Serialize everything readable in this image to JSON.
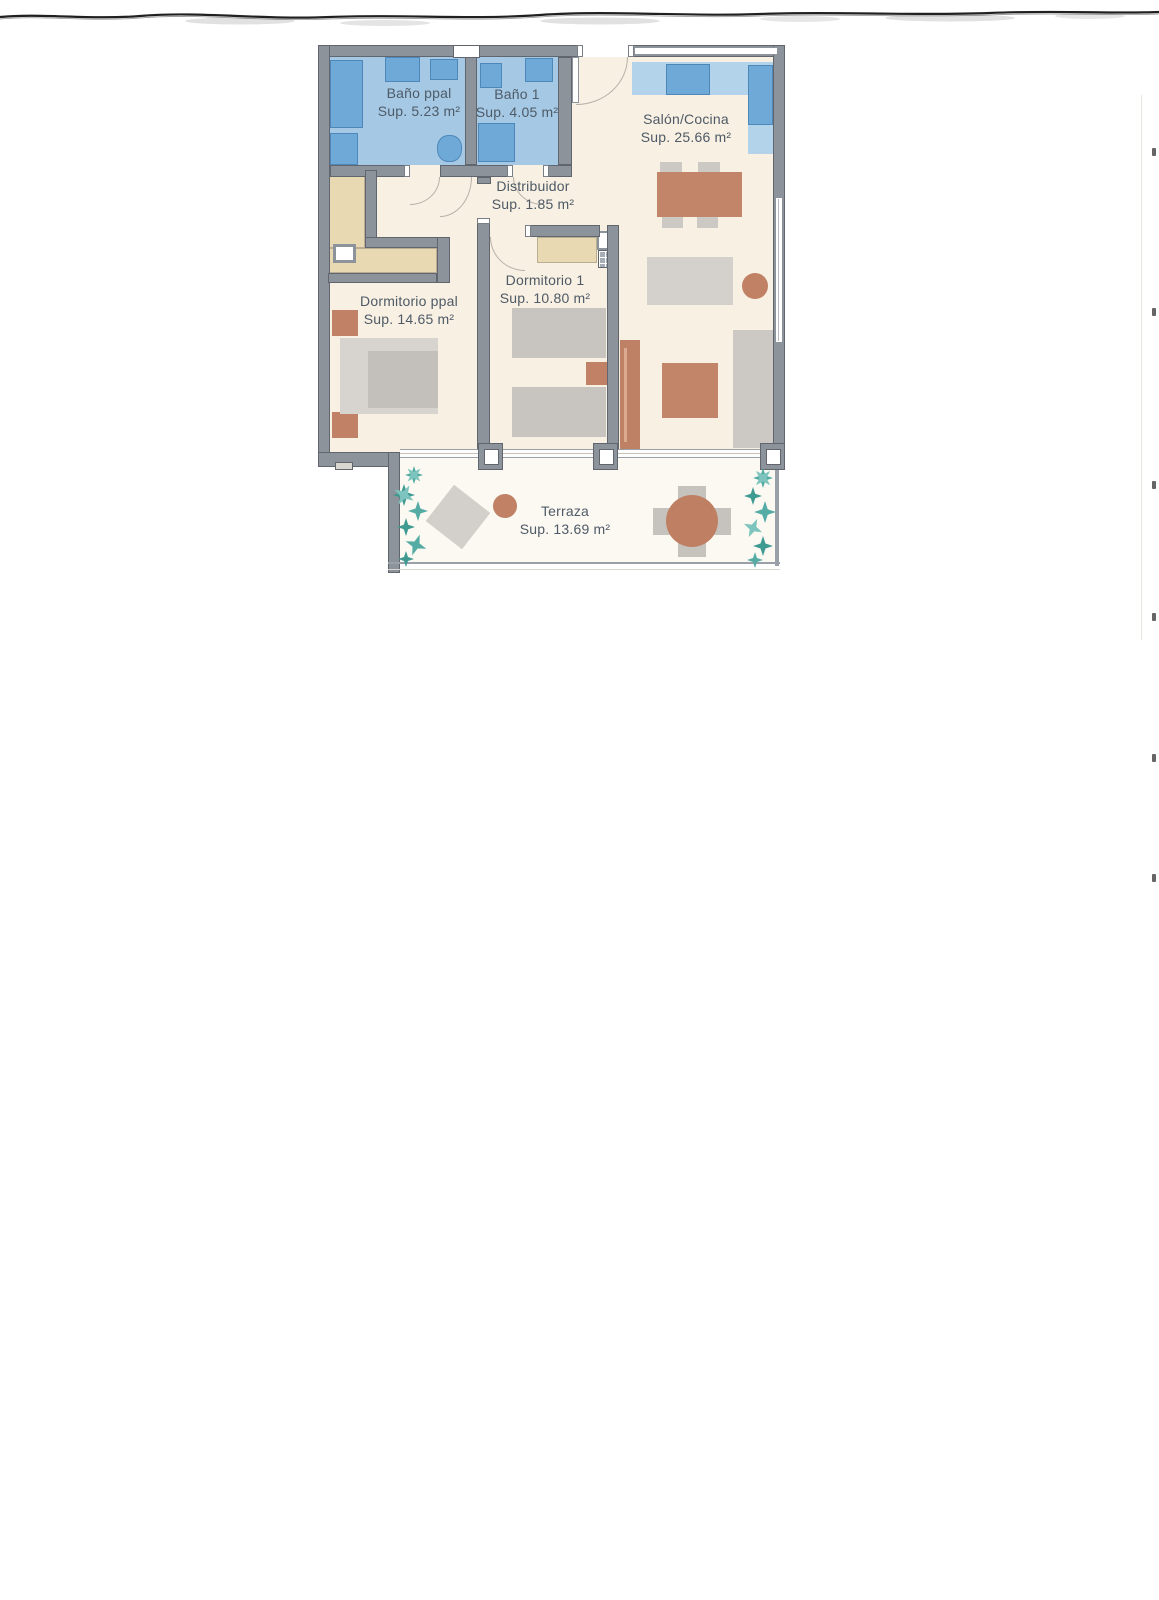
{
  "document": {
    "type": "apartment floor plan (scanned drawing)"
  },
  "rooms": [
    {
      "name": "Baño ppal",
      "area": "Sup. 5.23 m²"
    },
    {
      "name": "Baño 1",
      "area": "Sup. 4.05 m²"
    },
    {
      "name": "Salón/Cocina",
      "area": "Sup. 25.66 m²"
    },
    {
      "name": "Distribuidor",
      "area": "Sup. 1.85 m²"
    },
    {
      "name": "Dormitorio 1",
      "area": "Sup. 10.80 m²"
    },
    {
      "name": "Dormitorio ppal",
      "area": "Sup. 14.65 m²"
    },
    {
      "name": "Terraza",
      "area": "Sup. 13.69 m²"
    }
  ],
  "palette": {
    "wall": "#8d939b",
    "wall_border": "#61666e",
    "interior_floor": "#f8f0e3",
    "terrace_floor": "#fcf9f3",
    "bath_floor": "#a5c9e5",
    "fixture_blue": "#6ea9d8",
    "counter_blue": "#b3d3ea",
    "closet_tan": "#e9d9b3",
    "furniture_gray": "#ccc9c4",
    "terracotta": "#c28569",
    "plant_teal": "#55aca4",
    "label_text": "#4e5a66"
  }
}
